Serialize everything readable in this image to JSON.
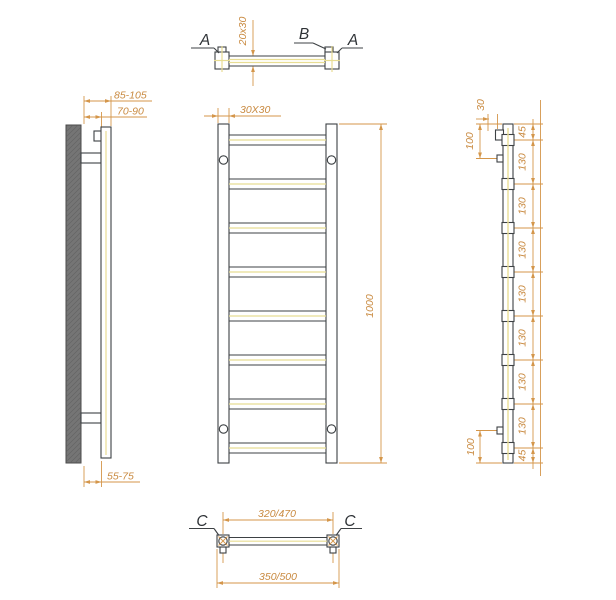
{
  "drawing": {
    "colors": {
      "dimension": "#d4964a",
      "outline": "#3d4144",
      "centerline": "#e8dd93",
      "wall_fill": "#757575",
      "background": "#ffffff"
    },
    "views": {
      "section_top": {
        "label_left": "A",
        "label_mid": "B",
        "label_right": "A",
        "dim_profile": "20x30"
      },
      "side_left": {
        "dim_wall_outer": "85-105",
        "dim_wall_inner": "70-90",
        "dim_wall_bottom": "55-75"
      },
      "front": {
        "dim_tube": "30X30",
        "dim_height": "1000",
        "rung_count": 8
      },
      "side_right": {
        "dim_depth": "30",
        "dim_top_bracket": "100",
        "dim_bottom_bracket": "100",
        "chain_segments": [
          "45",
          "130",
          "130",
          "130",
          "130",
          "130",
          "130",
          "130",
          "45"
        ]
      },
      "section_bottom": {
        "label_left": "C",
        "label_right": "C",
        "dim_axes": "320/470",
        "dim_overall": "350/500"
      }
    }
  }
}
